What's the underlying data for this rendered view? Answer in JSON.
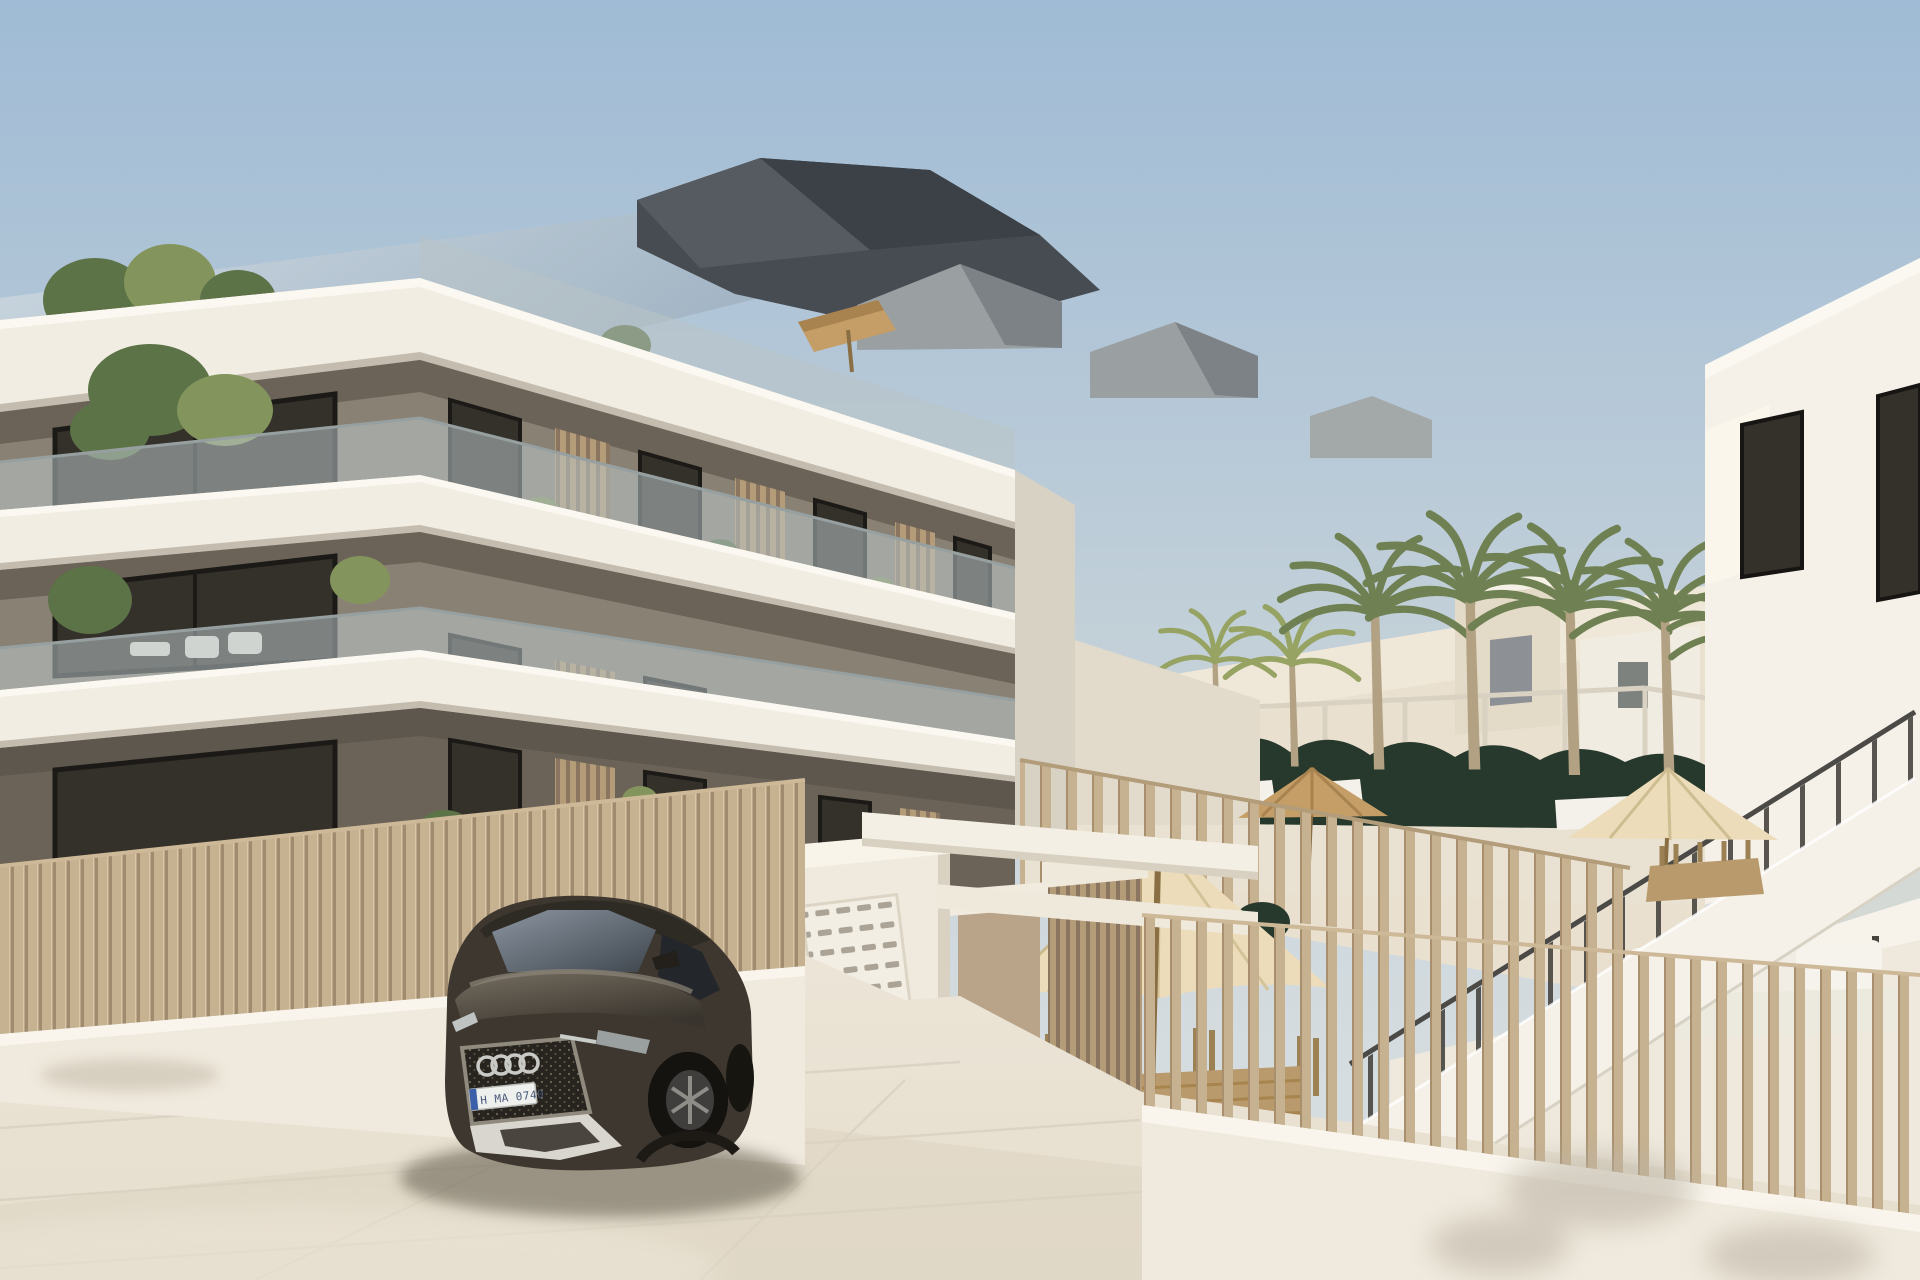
{
  "scene": {
    "description": "Sunny 3D architectural render of a modern three-storey apartment building with white balcony slabs, taupe walls, glass balustrades and wooden slat screens; tan slatted fences, an entrance pillar with mailboxes, a dark Audi SUV parked in front, palm trees, a hedge-lined pool terrace with cream parasols and a white side building with an external staircase.",
    "time_of_day": "daytime",
    "weather": "clear"
  },
  "car": {
    "brand_mark": "audi-four-rings",
    "license_plate": "H MA 0740"
  },
  "counts": {
    "building_floors": 3,
    "tall_palm_trees": 5,
    "small_palm_trees": 2,
    "parasols": 3
  },
  "palette": {
    "sky_top": "#9fbbd5",
    "sky_low": "#d6dde0",
    "roof_glass": "#bccdda",
    "roof_dark": "#474c52",
    "band_white": "#f2ede2",
    "band_shade": "#ddd6c8",
    "band_under": "#c4bcae",
    "wall_taupe": "#8a8175",
    "wall_dark": "#6b6357",
    "window_dark": "#34302a",
    "frame_dark": "#201d1a",
    "slat_wood": "#b59c79",
    "slat_gap": "#8a7560",
    "glass_tint": "#b9c4c6",
    "plant_green": "#5c7247",
    "plant_light": "#83955c",
    "palm_green": "#6f8152",
    "palm_yellow": "#96a363",
    "hedge_dark": "#27392c",
    "fence_tan": "#c6b190",
    "fence_gap": "#a08b6e",
    "pave_light": "#ece5d7",
    "pave_dark": "#ddd4c3",
    "wall_white": "#f0eade",
    "cream_bg": "#e9e0cf",
    "umbrella_cream": "#ecdcba",
    "umbrella_tan": "#c49e66",
    "wood_tan": "#b99a6d",
    "car_body": "#3d372f",
    "car_dark": "#27231e",
    "car_glass": "#6d7884",
    "chrome": "#c9c9c6",
    "shadow": "#55503f",
    "stair_white": "#f5f1e8",
    "post_dark": "#46443f"
  }
}
